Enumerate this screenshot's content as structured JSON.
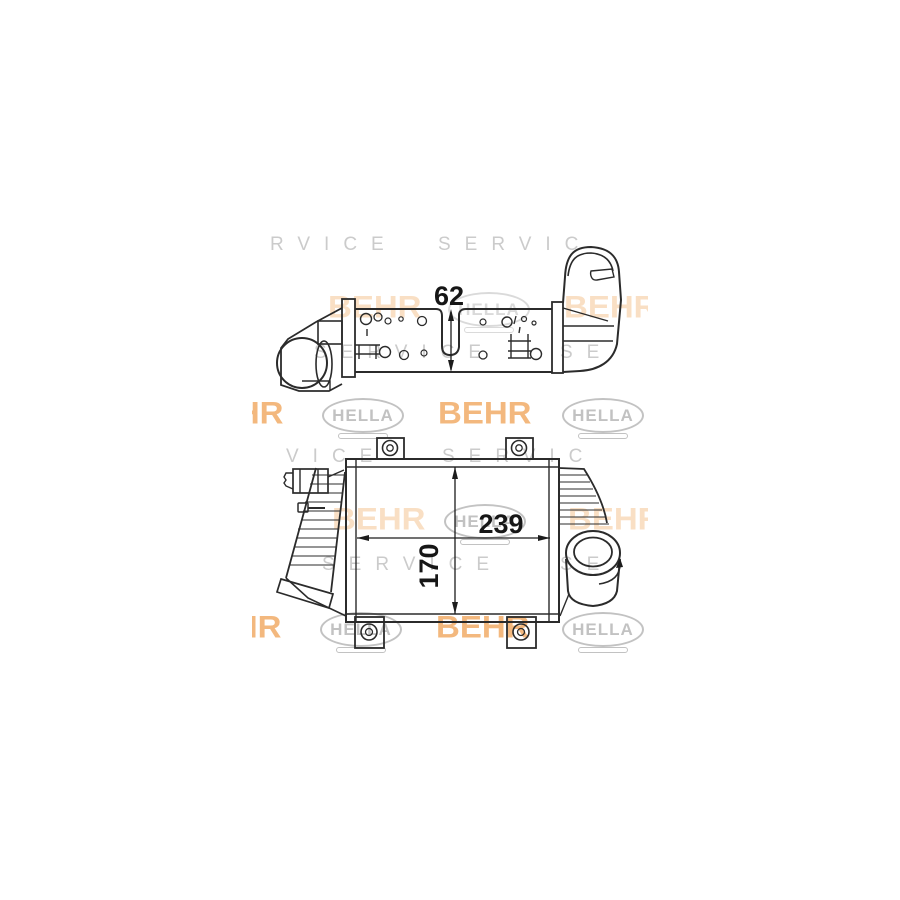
{
  "product_image": {
    "description": "technical line drawing of an intercooler, two views, with watermark",
    "dimensions": {
      "depth": "62",
      "width": "239",
      "height": "170"
    },
    "watermark": {
      "brand1": "BEHR",
      "brand2": "HELLA",
      "service_word": "SERVICE",
      "colors": {
        "behr_orange": "#efa153",
        "behr_pale": "#f4c08a",
        "logo_gray": "#bcbcbc",
        "letter_gray": "#c9c9c9",
        "line_color": "#2b2b2b"
      },
      "letter_rows": [
        {
          "y": 6,
          "segments": [
            {
              "x": 18,
              "text": "RVICE"
            },
            {
              "x": 186,
              "text": "SERVIC"
            }
          ]
        },
        {
          "y": 114,
          "segments": [
            {
              "x": 62,
              "text": "SERVICE"
            },
            {
              "x": 308,
              "text": "SE"
            }
          ]
        },
        {
          "y": 218,
          "segments": [
            {
              "x": 34,
              "text": "VICE"
            },
            {
              "x": 190,
              "text": "SERVIC"
            }
          ]
        },
        {
          "y": 326,
          "segments": [
            {
              "x": 70,
              "text": "SERVICE"
            },
            {
              "x": 308,
              "text": "SE"
            }
          ]
        }
      ],
      "logo_rows": [
        {
          "y": 64,
          "items": [
            {
              "type": "behr",
              "x": 76,
              "tone": "pale"
            },
            {
              "type": "hella",
              "x": 196,
              "tone": "pale"
            },
            {
              "type": "behr",
              "x": 312,
              "tone": "pale"
            }
          ]
        },
        {
          "y": 170,
          "items": [
            {
              "type": "behr",
              "x": -62,
              "tone": "strong"
            },
            {
              "type": "hella",
              "x": 70,
              "tone": "strong"
            },
            {
              "type": "behr",
              "x": 186,
              "tone": "strong"
            },
            {
              "type": "hella",
              "x": 310,
              "tone": "strong"
            }
          ]
        },
        {
          "y": 276,
          "items": [
            {
              "type": "behr",
              "x": 80,
              "tone": "pale"
            },
            {
              "type": "hella",
              "x": 192,
              "tone": "strong"
            },
            {
              "type": "behr",
              "x": 316,
              "tone": "pale"
            }
          ]
        },
        {
          "y": 384,
          "items": [
            {
              "type": "behr",
              "x": -64,
              "tone": "strong"
            },
            {
              "type": "hella",
              "x": 68,
              "tone": "strong"
            },
            {
              "type": "behr",
              "x": 184,
              "tone": "strong"
            },
            {
              "type": "hella",
              "x": 310,
              "tone": "strong"
            }
          ]
        }
      ]
    }
  }
}
